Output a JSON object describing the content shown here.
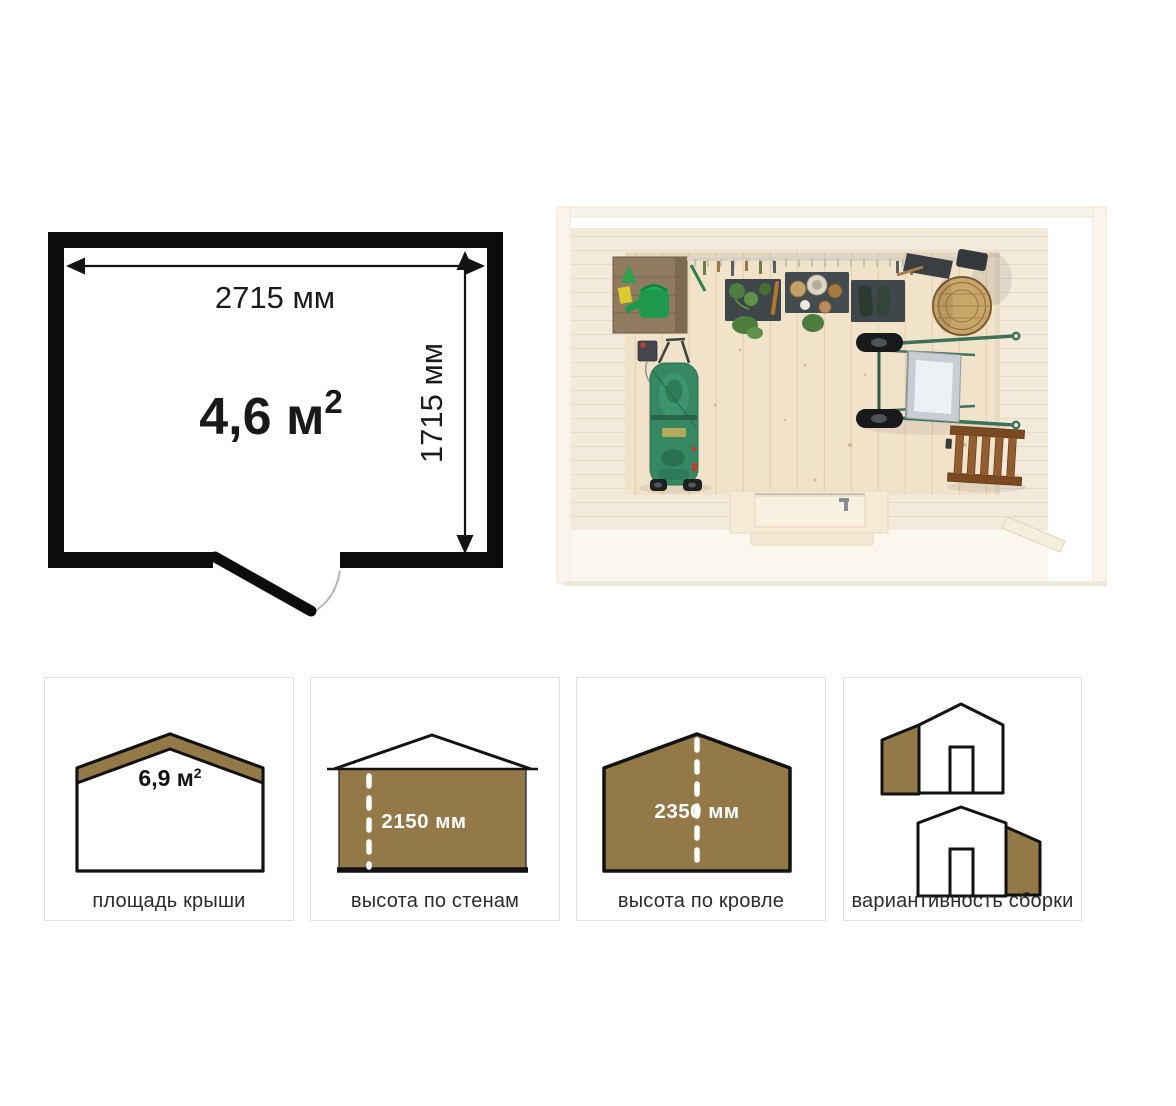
{
  "floor_plan": {
    "width_dim": "2715 мм",
    "height_dim": "1715 мм",
    "area_value": "4,6 м",
    "area_superscript": "2"
  },
  "interior_render": {
    "items": [
      "storage-crate",
      "watering-can",
      "tool-rail",
      "tool-panels",
      "plants",
      "boots",
      "tarp-and-shears",
      "wooden-barrel",
      "battery-charger",
      "lawnmower",
      "garden-cart",
      "wooden-ladder",
      "door-threshold",
      "open-door"
    ]
  },
  "info_cards": [
    {
      "label": "площадь крыши",
      "value": "6,9 м",
      "value_superscript": "2"
    },
    {
      "label": "высота по стенам",
      "value": "2150 мм"
    },
    {
      "label": "высота по кровле",
      "value": "2350 мм"
    },
    {
      "label": "вариантивность сборки"
    }
  ],
  "colors": {
    "accent_brown": "#927947",
    "outline_black": "#121212",
    "card_border": "#e3e1df",
    "dimension_text": "#1b1b1b",
    "label_text": "#2c2c2c",
    "value_text_light": "#ffffff"
  }
}
